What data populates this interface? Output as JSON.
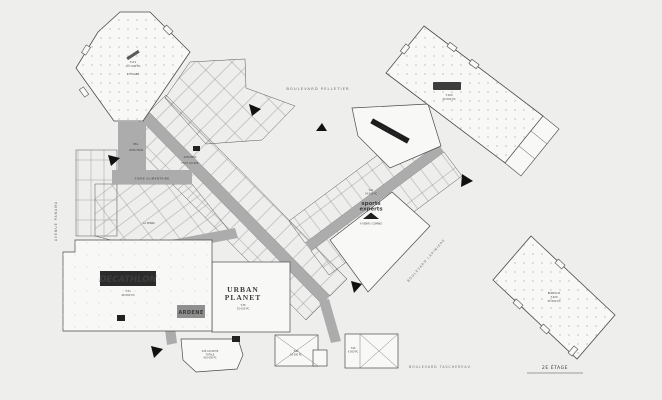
{
  "canvas": {
    "background": "#eeeeed",
    "line_color": "#4a4a4a",
    "corridor_color": "#acacac",
    "anchor_fill": "#f8f8f7",
    "logo_dark": "#2b2b2b",
    "ardene_gray": "#8f8f8f"
  },
  "streets": {
    "top": "BOULEVARD PELLETIER",
    "left": "AVENUE PANAMA",
    "right": "BOULEVARD LAPINIÈRE",
    "bottom": "BOULEVARD TASCHEREAU"
  },
  "floor_caption": "2E ÉTAGE",
  "anchors": {
    "northwest": {
      "lines": [
        "T-01",
        "117 000 PC",
        "2 ÉTAGES"
      ]
    },
    "northeast": {
      "logo": "AVRIL",
      "unit": "T-100",
      "area": "40 000 PC"
    },
    "southeast": {
      "lines": [
        "BUREAUX",
        "T-200",
        "45 000 PC"
      ]
    }
  },
  "stores": {
    "decathlon": {
      "name": "DECATHLON",
      "unit": "T-51",
      "area": "48 000 PC"
    },
    "ardene": {
      "name": "ARDENE"
    },
    "urban_planet": {
      "line1": "URBAN",
      "line2": "PLANET",
      "unit": "T-36",
      "area": "25 000 PC"
    },
    "sports_experts": {
      "line1": "sports",
      "line2": "experts",
      "unit": "T-61",
      "area": "34 000 PC",
      "status": "À VENIR / COMING"
    },
    "linen_chest": {
      "name": "LINEN CHEST"
    },
    "food_court": {
      "name": "FOIRE ALIMENTAIRE"
    },
    "annex": {
      "lines": [
        "SUP. LOCATIVE",
        "TOTALE",
        "410 000 PC"
      ]
    },
    "pad_west": {
      "unit": "T-94",
      "area": "10 000 PC"
    },
    "pad_east": {
      "unit": "T-96",
      "area": "6 500 PC"
    }
  },
  "unit_labels": [
    {
      "text": "BELL"
    },
    {
      "text": "VIDÉOTRON"
    },
    {
      "text": "SKECHERS"
    },
    {
      "text": "FOOT LOCKER"
    },
    {
      "text": "LA SENZA"
    }
  ]
}
